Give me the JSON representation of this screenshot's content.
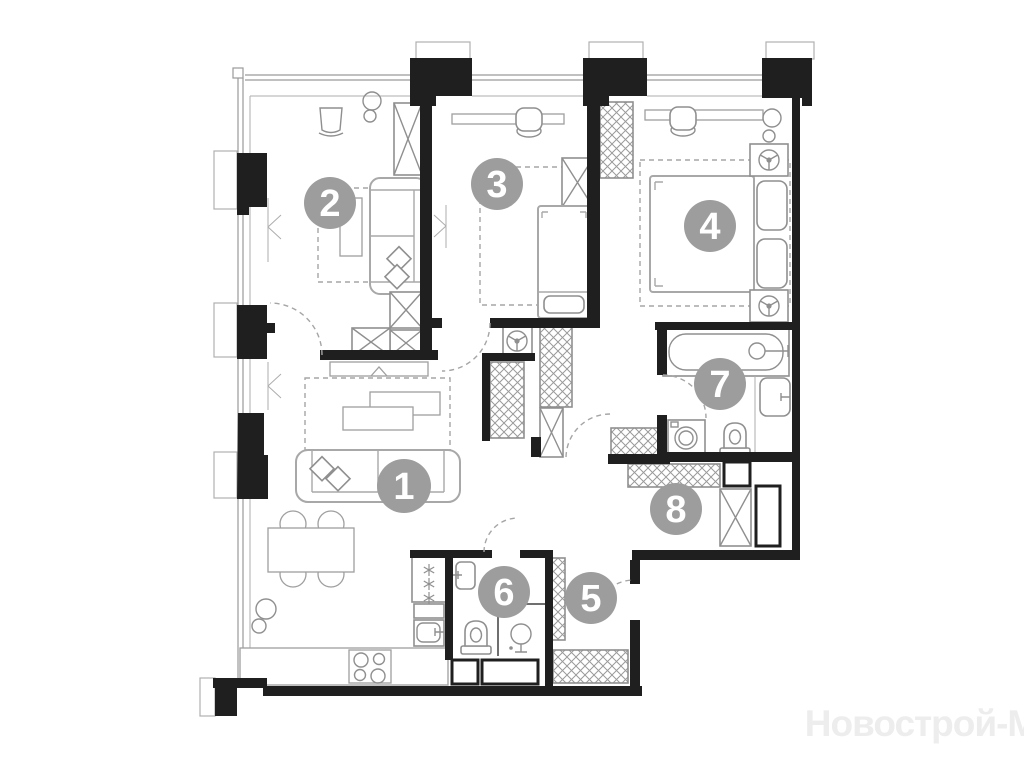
{
  "plan_type": "apartment-floor-plan",
  "watermark": {
    "text": "Новострой-М",
    "color": "#ededed"
  },
  "badges": [
    {
      "number": "1"
    },
    {
      "number": "2"
    },
    {
      "number": "3"
    },
    {
      "number": "4"
    },
    {
      "number": "5"
    },
    {
      "number": "6"
    },
    {
      "number": "7"
    },
    {
      "number": "8"
    }
  ],
  "colors": {
    "background": "#ffffff",
    "wall": "#1f1f1f",
    "furniture": "#8f8f8f",
    "furniture_light": "#a8a8a8",
    "glazing": "#9a9a9a",
    "dashed": "#a5a5a5",
    "badge_fill": "#9d9d9d",
    "badge_text": "#ffffff"
  }
}
